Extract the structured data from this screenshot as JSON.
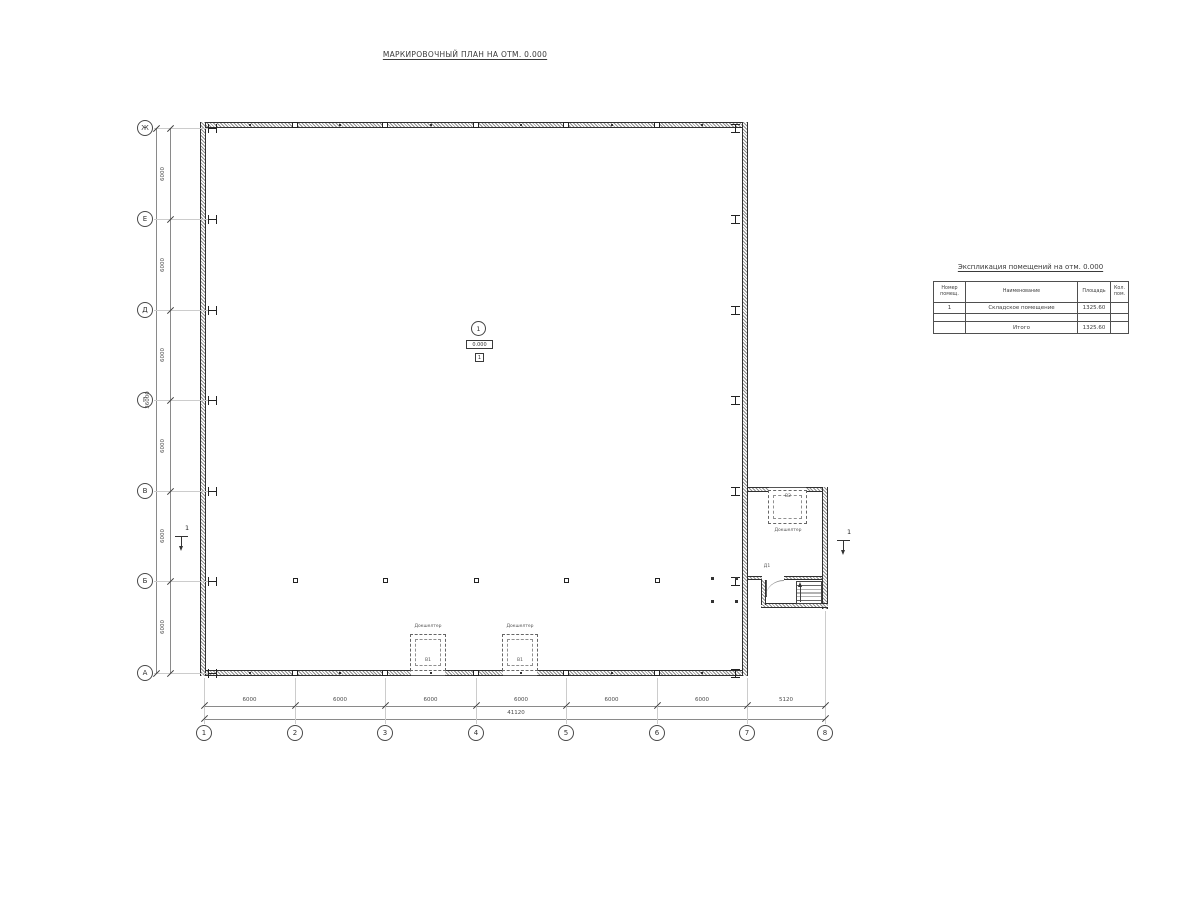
{
  "drawing_title": "МАРКИРОВОЧНЫЙ ПЛАН НА ОТМ. 0.000",
  "axes": {
    "rows": [
      "Ж",
      "Е",
      "Д",
      "Г",
      "В",
      "Б",
      "А"
    ],
    "cols": [
      "1",
      "2",
      "3",
      "4",
      "5",
      "6",
      "7",
      "8"
    ]
  },
  "dims": {
    "left_segments": [
      "6000",
      "6000",
      "6000",
      "6000",
      "6000",
      "6000"
    ],
    "left_total": "36000",
    "bottom_segments": [
      "6000",
      "6000",
      "6000",
      "6000",
      "6000",
      "6000",
      "5120"
    ],
    "bottom_total": "41120"
  },
  "room": {
    "number": "1",
    "elevation": "0.000",
    "floor_mark": "1"
  },
  "docks": [
    {
      "label": "Докшелтер",
      "mark": "В1"
    },
    {
      "label": "Докшелтер",
      "mark": "В1"
    },
    {
      "label": "Докшелтер",
      "mark": "В2"
    }
  ],
  "door_mark": "Д1",
  "sections": {
    "left": "1",
    "right": "1"
  },
  "table": {
    "title": "Экспликация помещений на отм. 0.000",
    "headers": [
      "Номер помещ.",
      "Наименование",
      "Площадь",
      "Кол. пом."
    ],
    "rows": [
      [
        "1",
        "Складское помещение",
        "1325.60",
        ""
      ]
    ],
    "total": {
      "label": "Итого",
      "value": "1325.60"
    }
  }
}
